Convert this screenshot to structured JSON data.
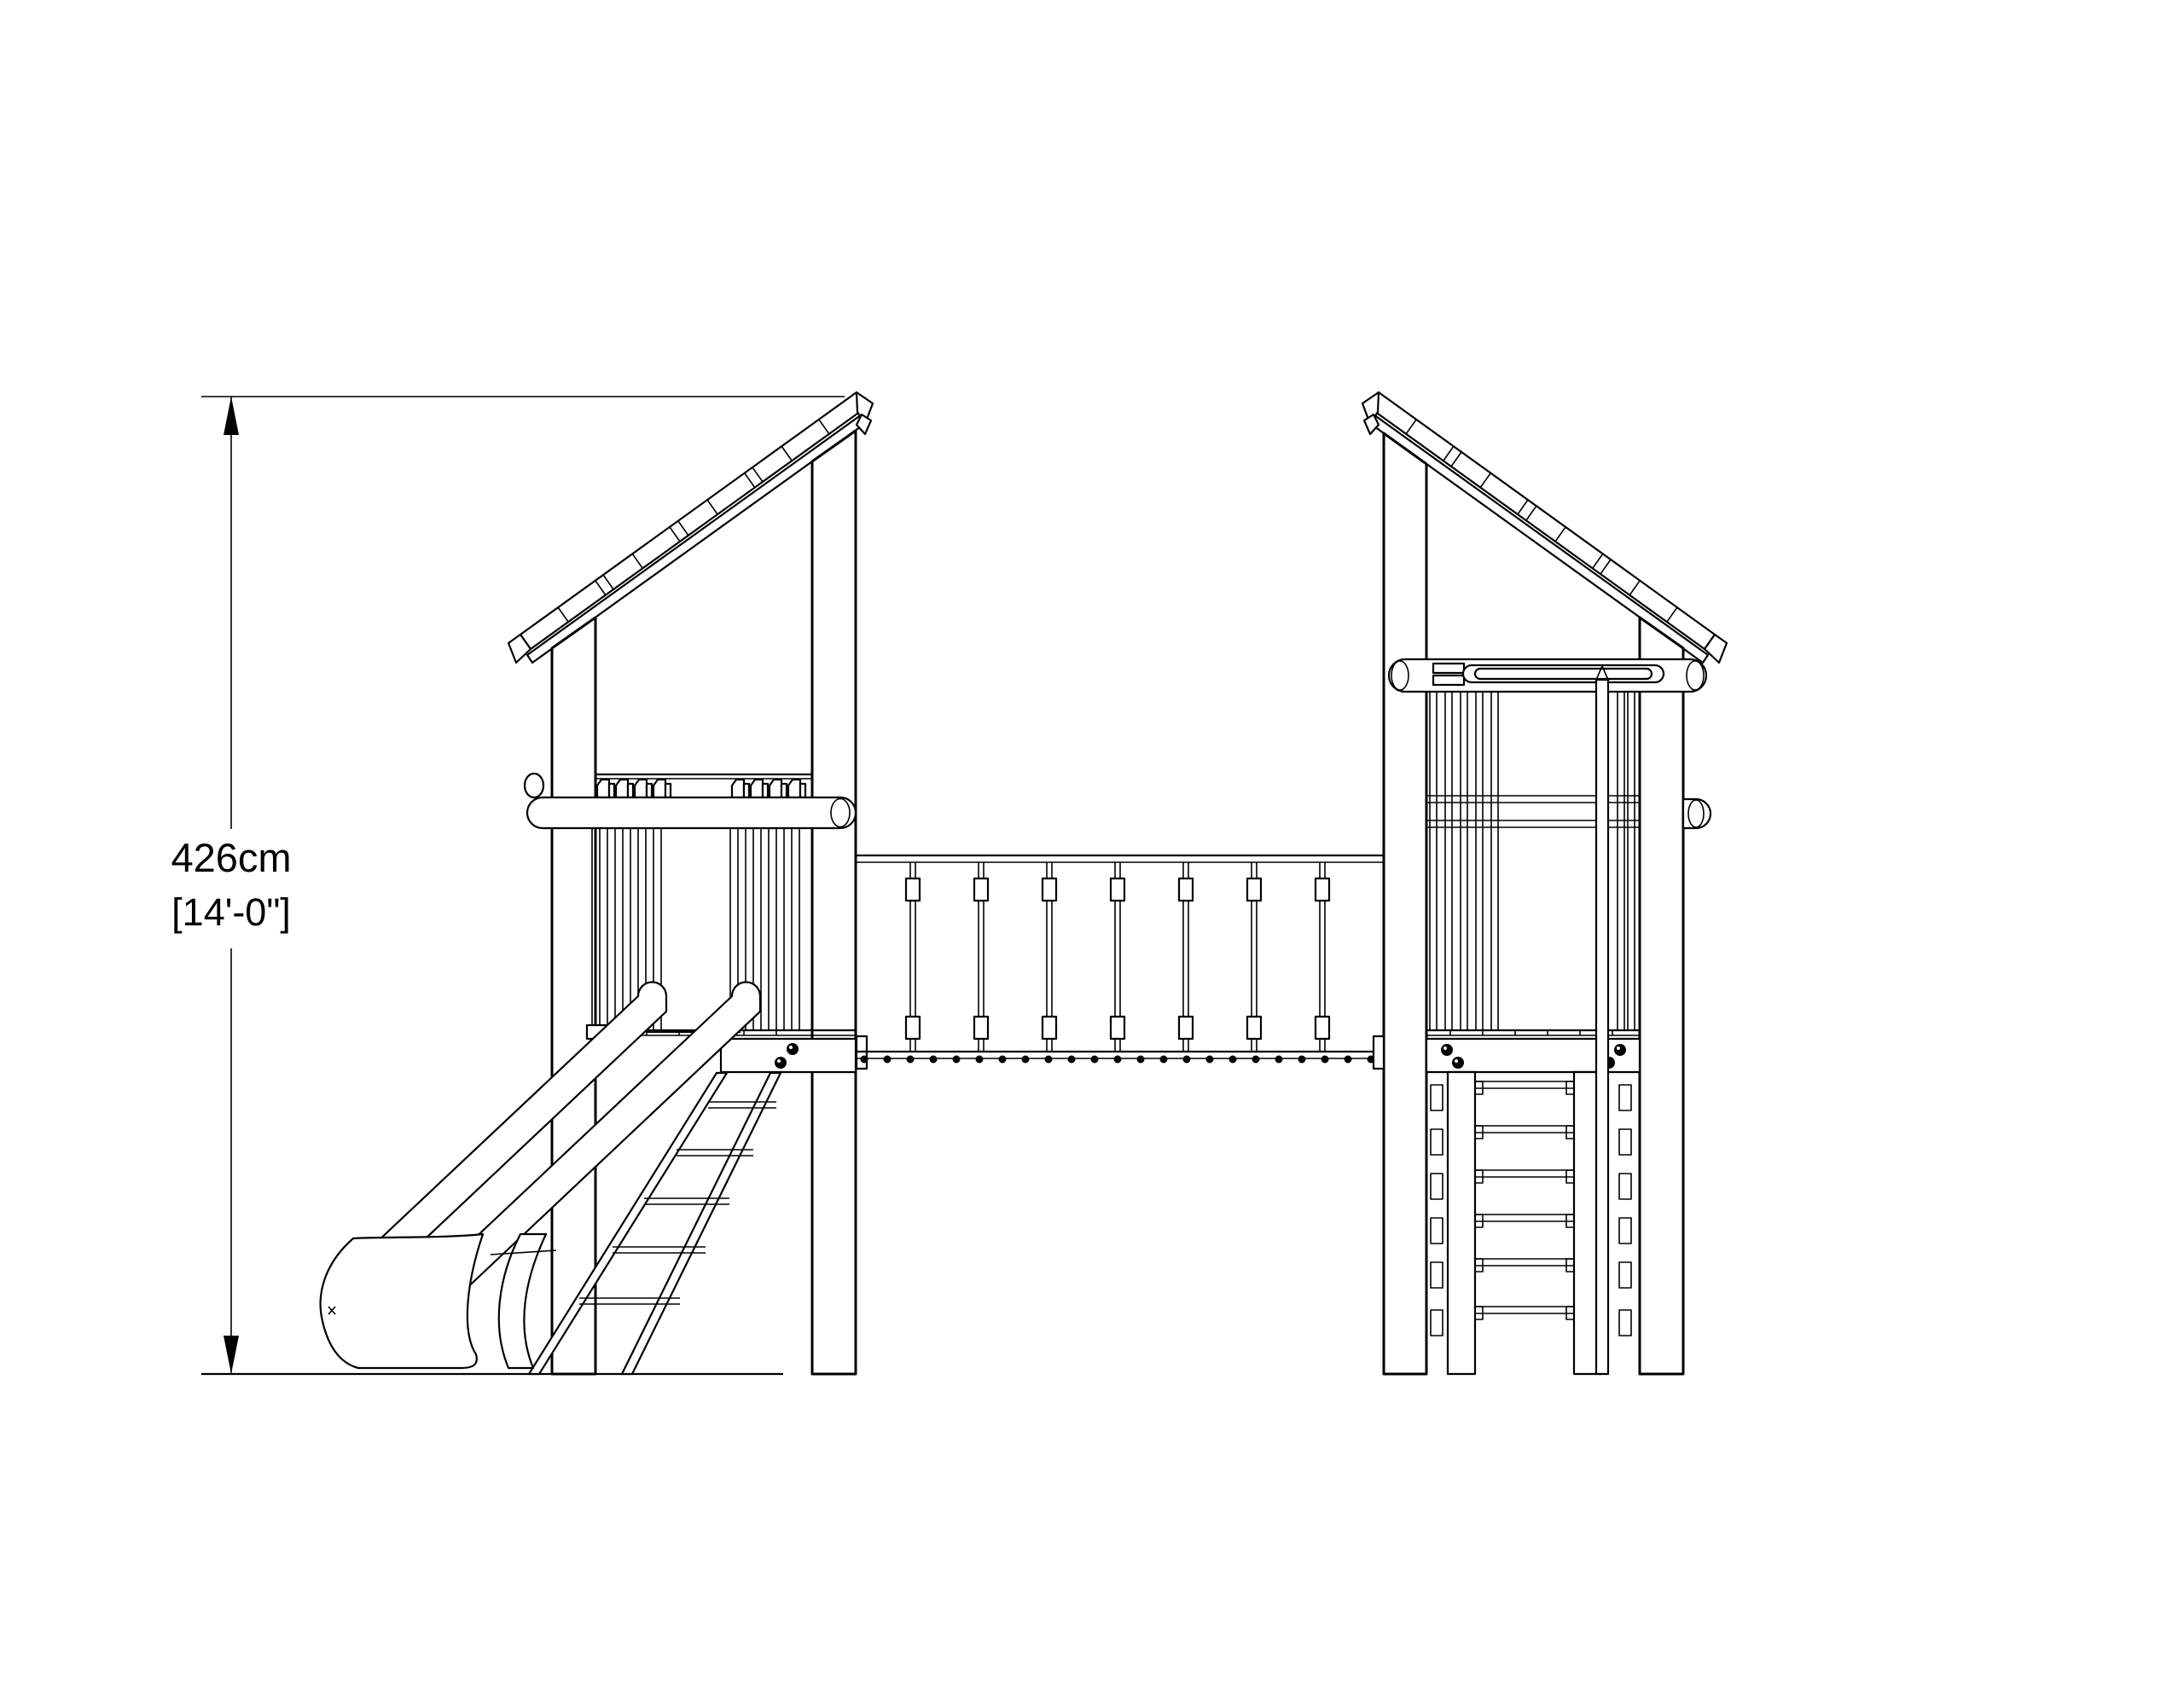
{
  "drawing": {
    "dimension": {
      "metric": "426cm",
      "imperial_bracketed": "[14'-0\"]"
    },
    "colors": {
      "line": "#000000",
      "background": "#ffffff"
    }
  }
}
